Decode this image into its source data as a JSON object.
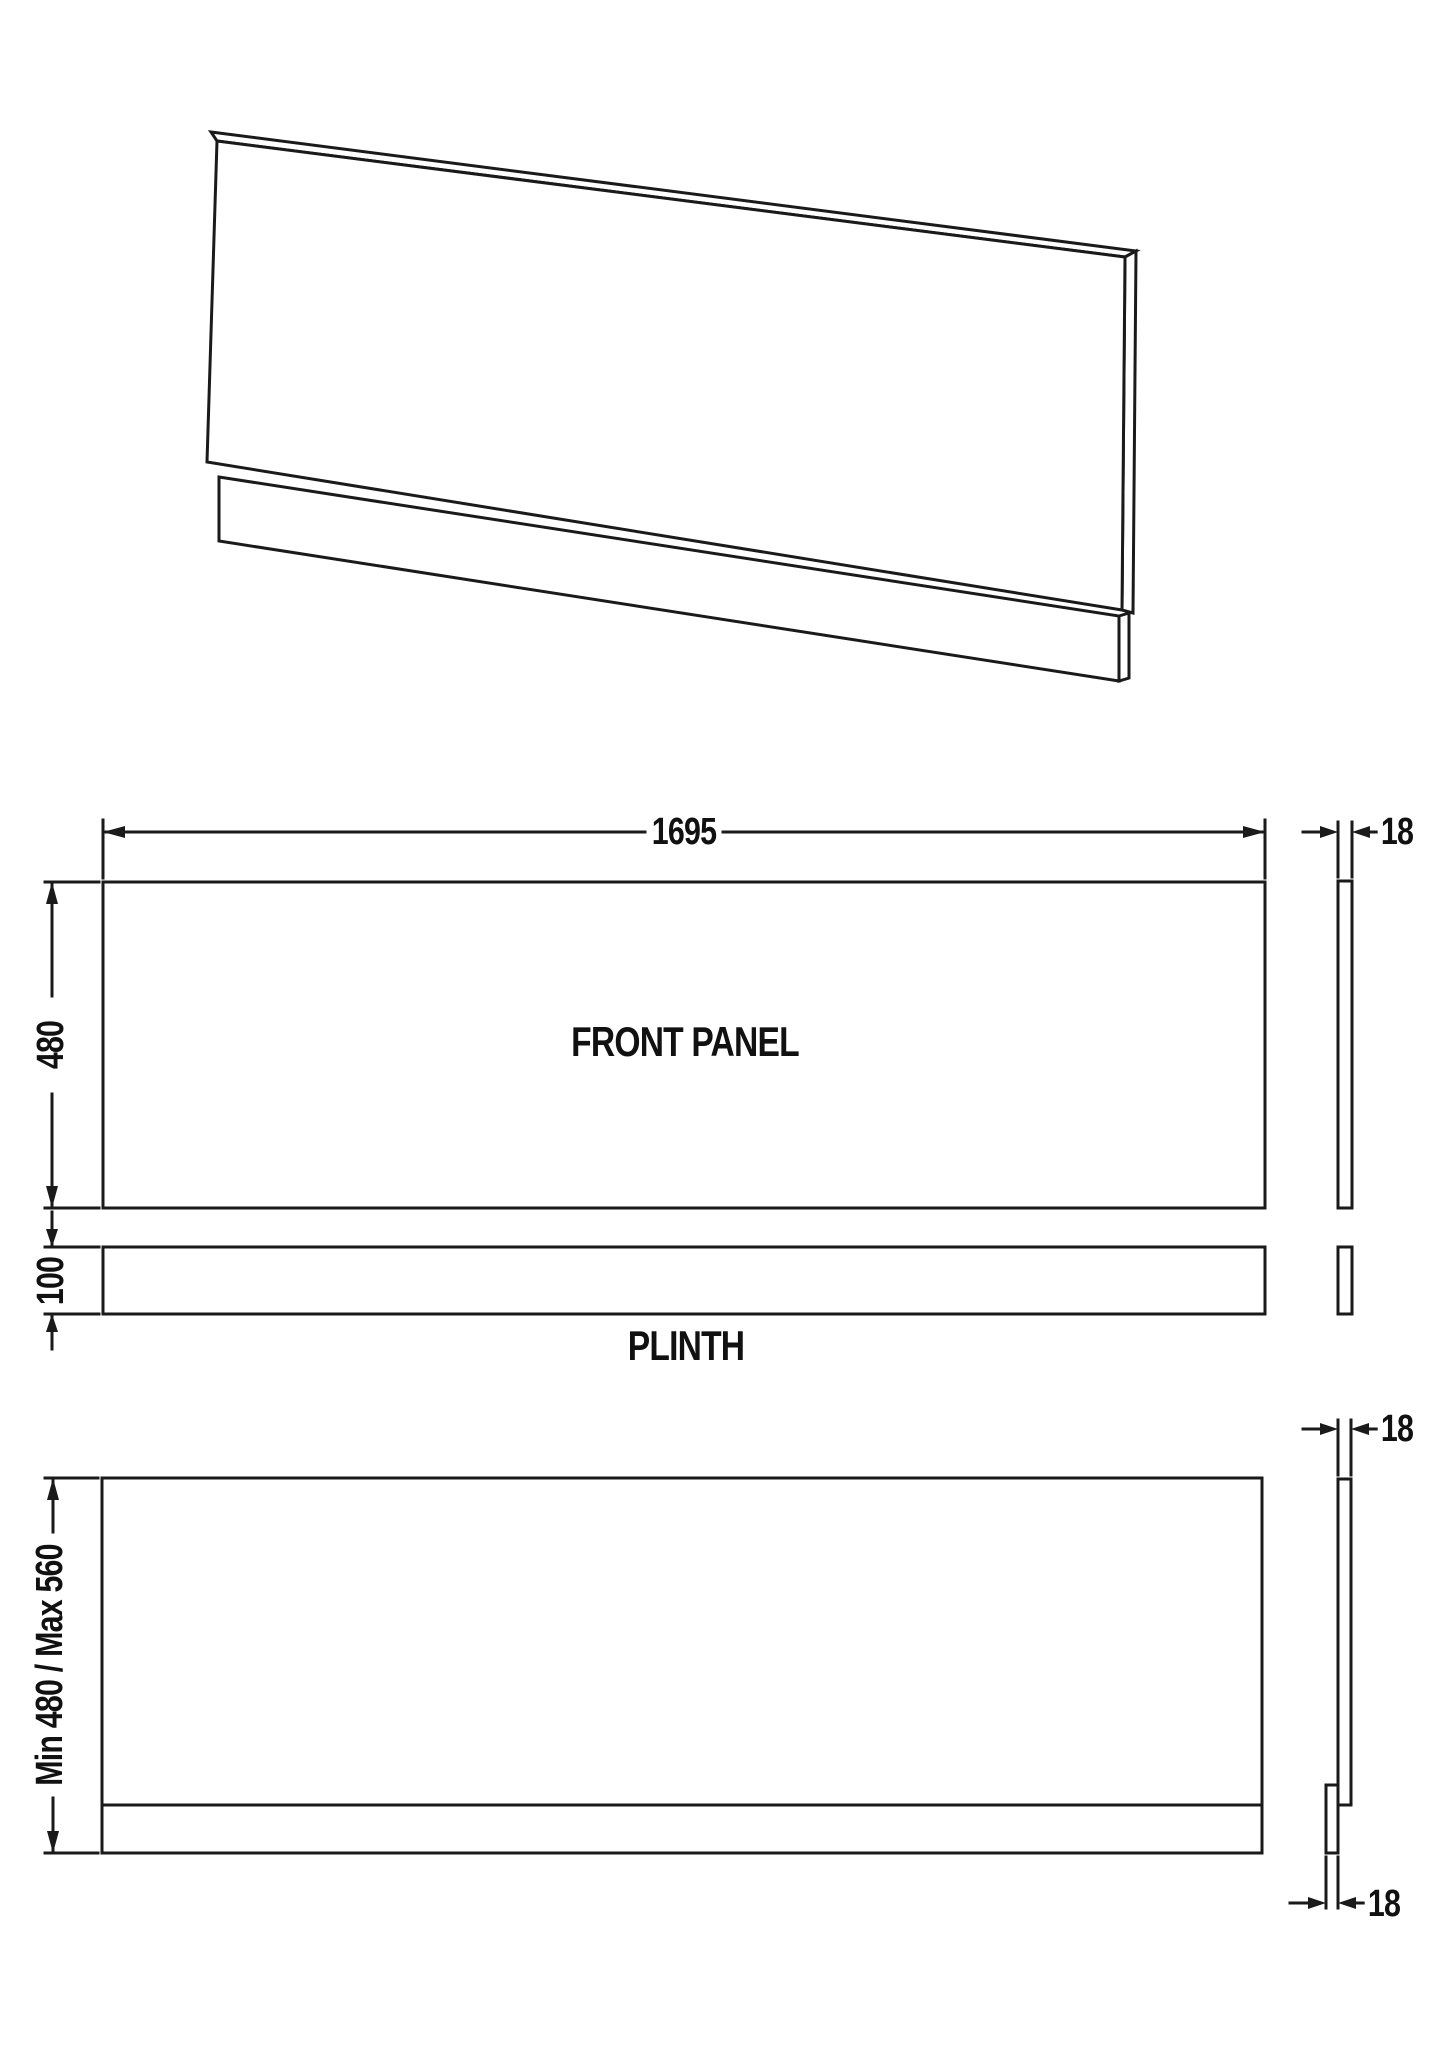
{
  "drawing": {
    "title_labels": {
      "front_panel": "FRONT PANEL",
      "plinth": "PLINTH"
    },
    "dimensions": {
      "front_width": "1695",
      "front_height": "480",
      "panel_thickness": "18",
      "plinth_height": "100",
      "assembled_height": "Min 480 / Max 560",
      "assembled_panel_thickness": "18",
      "assembled_plinth_thickness": "18"
    },
    "colors": {
      "line": "#1a1a1a",
      "background": "#ffffff"
    }
  }
}
